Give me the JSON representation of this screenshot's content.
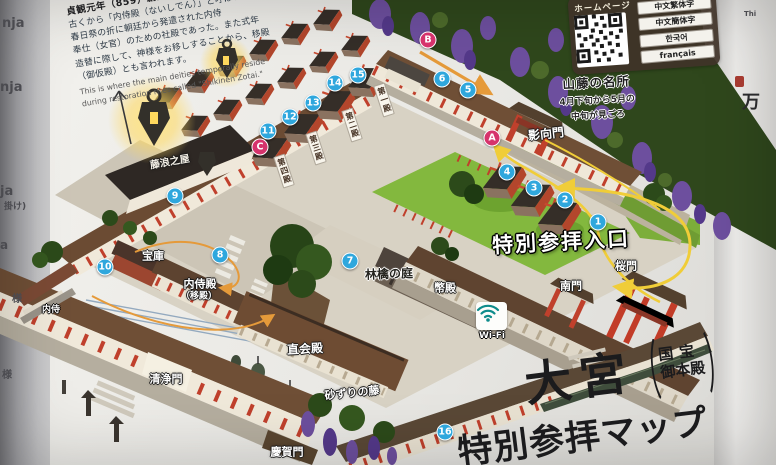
{
  "info_panel": {
    "heading_partial": "Naishiden",
    "founded": "貞観元年（859）創建",
    "body_lines": [
      "古くから「内侍殿（ないしでん）」と呼ばれ、",
      "春日祭の折に朝廷から発遣された内侍",
      "奉仕（女官）のための社殿であった。また式年",
      "造替に際して、神様をお移しすることから、移殿",
      "（御仮殿）とも言われます。"
    ],
    "english_lines": [
      "This is where the main deities temporally reside",
      "during restoration rites called \"Shikinen Zotai.\""
    ]
  },
  "homepage": {
    "label": "ホームページ",
    "languages": [
      "中文繁体字",
      "中文簡体字",
      "한국어",
      "français"
    ]
  },
  "wisteria_note": {
    "title": "山藤の名所",
    "lines": [
      "4月下旬から5月の",
      "中旬が見ごろ"
    ]
  },
  "entrance_banner": "特別参拝入口",
  "wifi_label": "Wi-Fi",
  "title_block": {
    "main": "大宮",
    "paren_line1": "国宝",
    "paren_line2": "御本殿",
    "subtitle": "特別参拝マップ"
  },
  "map_labels": [
    {
      "id": "yogo-gate-label",
      "text": "影向門",
      "x": 546,
      "y": 134,
      "size": 12,
      "color": "#ffffff",
      "rot": -6,
      "outline": true
    },
    {
      "id": "fujinami-house-label",
      "text": "藤浪之屋",
      "x": 170,
      "y": 163,
      "size": 10,
      "color": "#f3efe6",
      "rot": -10,
      "outline": true
    },
    {
      "id": "treasure-house-label",
      "text": "宝庫",
      "x": 153,
      "y": 256,
      "size": 11,
      "color": "#ffffff",
      "rot": 0,
      "outline": true
    },
    {
      "id": "naishiden-label",
      "text": "内侍殿",
      "x": 200,
      "y": 284,
      "size": 11,
      "color": "#ffffff",
      "rot": 0,
      "outline": true
    },
    {
      "id": "utsushidono-label",
      "text": "（移殿）",
      "x": 199,
      "y": 297,
      "size": 9,
      "color": "#ffffff",
      "rot": 0,
      "outline": true
    },
    {
      "id": "ringo-garden-label",
      "text": "林檎の庭",
      "x": 389,
      "y": 274,
      "size": 12,
      "color": "#24241f",
      "rot": -2,
      "halo": true
    },
    {
      "id": "heiden-label",
      "text": "幣殿",
      "x": 445,
      "y": 288,
      "size": 11,
      "color": "#ffffff",
      "rot": 0,
      "outline": true
    },
    {
      "id": "naoraiden-label",
      "text": "直会殿",
      "x": 305,
      "y": 349,
      "size": 12,
      "color": "#ffffff",
      "rot": -3,
      "outline": true
    },
    {
      "id": "seijomon-label",
      "text": "清浄門",
      "x": 166,
      "y": 379,
      "size": 11,
      "color": "#ffffff",
      "rot": 0,
      "outline": true
    },
    {
      "id": "sunazuri-fuji-label",
      "text": "砂ずりの藤",
      "x": 352,
      "y": 393,
      "size": 11,
      "color": "#ffffff",
      "rot": -6,
      "outline": true
    },
    {
      "id": "keigamon-label",
      "text": "慶賀門",
      "x": 287,
      "y": 452,
      "size": 11,
      "color": "#ffffff",
      "rot": 0,
      "outline": true
    },
    {
      "id": "nanmon-label",
      "text": "南門",
      "x": 571,
      "y": 286,
      "size": 11,
      "color": "#ffffff",
      "rot": 0,
      "outline": true
    },
    {
      "id": "sakuramon-label",
      "text": "桜門",
      "x": 626,
      "y": 266,
      "size": 11,
      "color": "#ffffff",
      "rot": 0,
      "outline": true
    },
    {
      "id": "hall1-banner",
      "text": "第一殿",
      "x": 384,
      "y": 100,
      "size": 8,
      "color": "#463325",
      "rot": -18,
      "vertical": true
    },
    {
      "id": "hall2-banner",
      "text": "第二殿",
      "x": 352,
      "y": 125,
      "size": 8,
      "color": "#463325",
      "rot": -18,
      "vertical": true
    },
    {
      "id": "hall3-banner",
      "text": "第三殿",
      "x": 316,
      "y": 148,
      "size": 8,
      "color": "#463325",
      "rot": -18,
      "vertical": true
    },
    {
      "id": "hall4-banner",
      "text": "第四殿",
      "x": 284,
      "y": 171,
      "size": 8,
      "color": "#463325",
      "rot": -18,
      "vertical": true
    }
  ],
  "markers": [
    {
      "label": "1",
      "type": "number",
      "x": 598,
      "y": 222
    },
    {
      "label": "2",
      "type": "number",
      "x": 565,
      "y": 200
    },
    {
      "label": "3",
      "type": "number",
      "x": 534,
      "y": 188
    },
    {
      "label": "4",
      "type": "number",
      "x": 507,
      "y": 172
    },
    {
      "label": "5",
      "type": "number",
      "x": 468,
      "y": 90
    },
    {
      "label": "6",
      "type": "number",
      "x": 442,
      "y": 79
    },
    {
      "label": "7",
      "type": "number",
      "x": 350,
      "y": 261
    },
    {
      "label": "8",
      "type": "number",
      "x": 220,
      "y": 255
    },
    {
      "label": "9",
      "type": "number",
      "x": 175,
      "y": 196
    },
    {
      "label": "10",
      "type": "number",
      "x": 105,
      "y": 267
    },
    {
      "label": "11",
      "type": "number",
      "x": 268,
      "y": 131
    },
    {
      "label": "12",
      "type": "number",
      "x": 290,
      "y": 117
    },
    {
      "label": "13",
      "type": "number",
      "x": 313,
      "y": 103
    },
    {
      "label": "14",
      "type": "number",
      "x": 335,
      "y": 83
    },
    {
      "label": "15",
      "type": "number",
      "x": 358,
      "y": 75
    },
    {
      "label": "16",
      "type": "number",
      "x": 445,
      "y": 432
    },
    {
      "label": "A",
      "type": "letter",
      "x": 492,
      "y": 138
    },
    {
      "label": "B",
      "type": "letter",
      "x": 428,
      "y": 40
    },
    {
      "label": "C",
      "type": "letter",
      "x": 260,
      "y": 147
    }
  ],
  "left_page_fragments": [
    {
      "text": "nja",
      "x": 2,
      "y": 16,
      "size": 13
    },
    {
      "text": "nja",
      "x": 0,
      "y": 80,
      "size": 13
    },
    {
      "text": "ja",
      "x": 0,
      "y": 184,
      "size": 13
    },
    {
      "text": "掛け)",
      "x": 4,
      "y": 199,
      "size": 9
    },
    {
      "text": "a",
      "x": 0,
      "y": 238,
      "size": 12
    },
    {
      "text": "様",
      "x": 12,
      "y": 290,
      "size": 10
    },
    {
      "text": "内侍",
      "x": 42,
      "y": 302,
      "size": 9,
      "white": true
    },
    {
      "text": "様",
      "x": 2,
      "y": 366,
      "size": 10
    }
  ],
  "right_page_fragments": [
    {
      "text": "Thi",
      "x": 744,
      "y": 10,
      "size": 7
    },
    {
      "text": "万",
      "x": 742,
      "y": 88,
      "size": 18,
      "serif": true
    }
  ],
  "colors": {
    "marker_blue": "#2fa7dd",
    "marker_pink": "#d6336c",
    "arrow_yellow": "#f0cd38",
    "arrow_orange": "#e59a3a",
    "grass_green": "#83b83e",
    "vermillion": "#c0402c",
    "roof_brown": "#6f4f36",
    "wisteria_purple": "#6d4f9e",
    "wifi_teal": "#0e8c8c",
    "lantern_glow": "#ffdf6e"
  }
}
